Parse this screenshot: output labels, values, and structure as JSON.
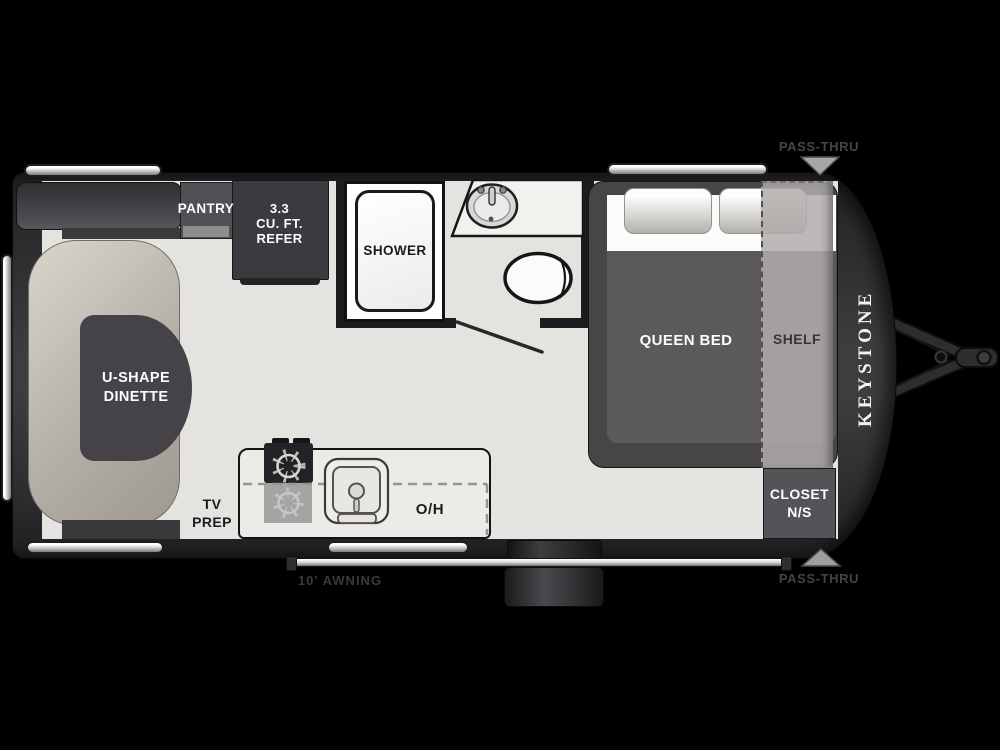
{
  "diagram": {
    "kind": "travel-trailer floorplan",
    "brand": {
      "logo_text": "KEYSTONE"
    },
    "rooms": {
      "dinette": {
        "line1": "U-SHAPE",
        "line2": "DINETTE"
      },
      "pantry": {
        "label": "PANTRY"
      },
      "refrigerator": {
        "line1": "3.3",
        "line2": "CU. FT.",
        "line3": "REFER"
      },
      "shower": {
        "label": "SHOWER"
      },
      "bedroom": {
        "bed_label": "QUEEN BED",
        "shelf_label": "SHELF"
      },
      "closet": {
        "line1": "CLOSET",
        "line2": "N/S"
      },
      "kitchen": {
        "tv_prep_line1": "TV",
        "tv_prep_line2": "PREP",
        "overhead_label": "O/H"
      }
    },
    "exterior": {
      "awning_label": "10' AWNING",
      "pass_thru_top": "PASS-THRU",
      "pass_thru_bottom": "PASS-THRU"
    },
    "colors": {
      "background": "#000000",
      "shell": "#3d3d40",
      "floor": "#e4e3e0",
      "furniture_dark": "#48454a",
      "bench": "#b4b0a8",
      "counter": "#edebe7",
      "label_white": "#fdfdfd",
      "label_dark": "#1c1c1e",
      "muted_exterior_text": "#45454d"
    }
  }
}
